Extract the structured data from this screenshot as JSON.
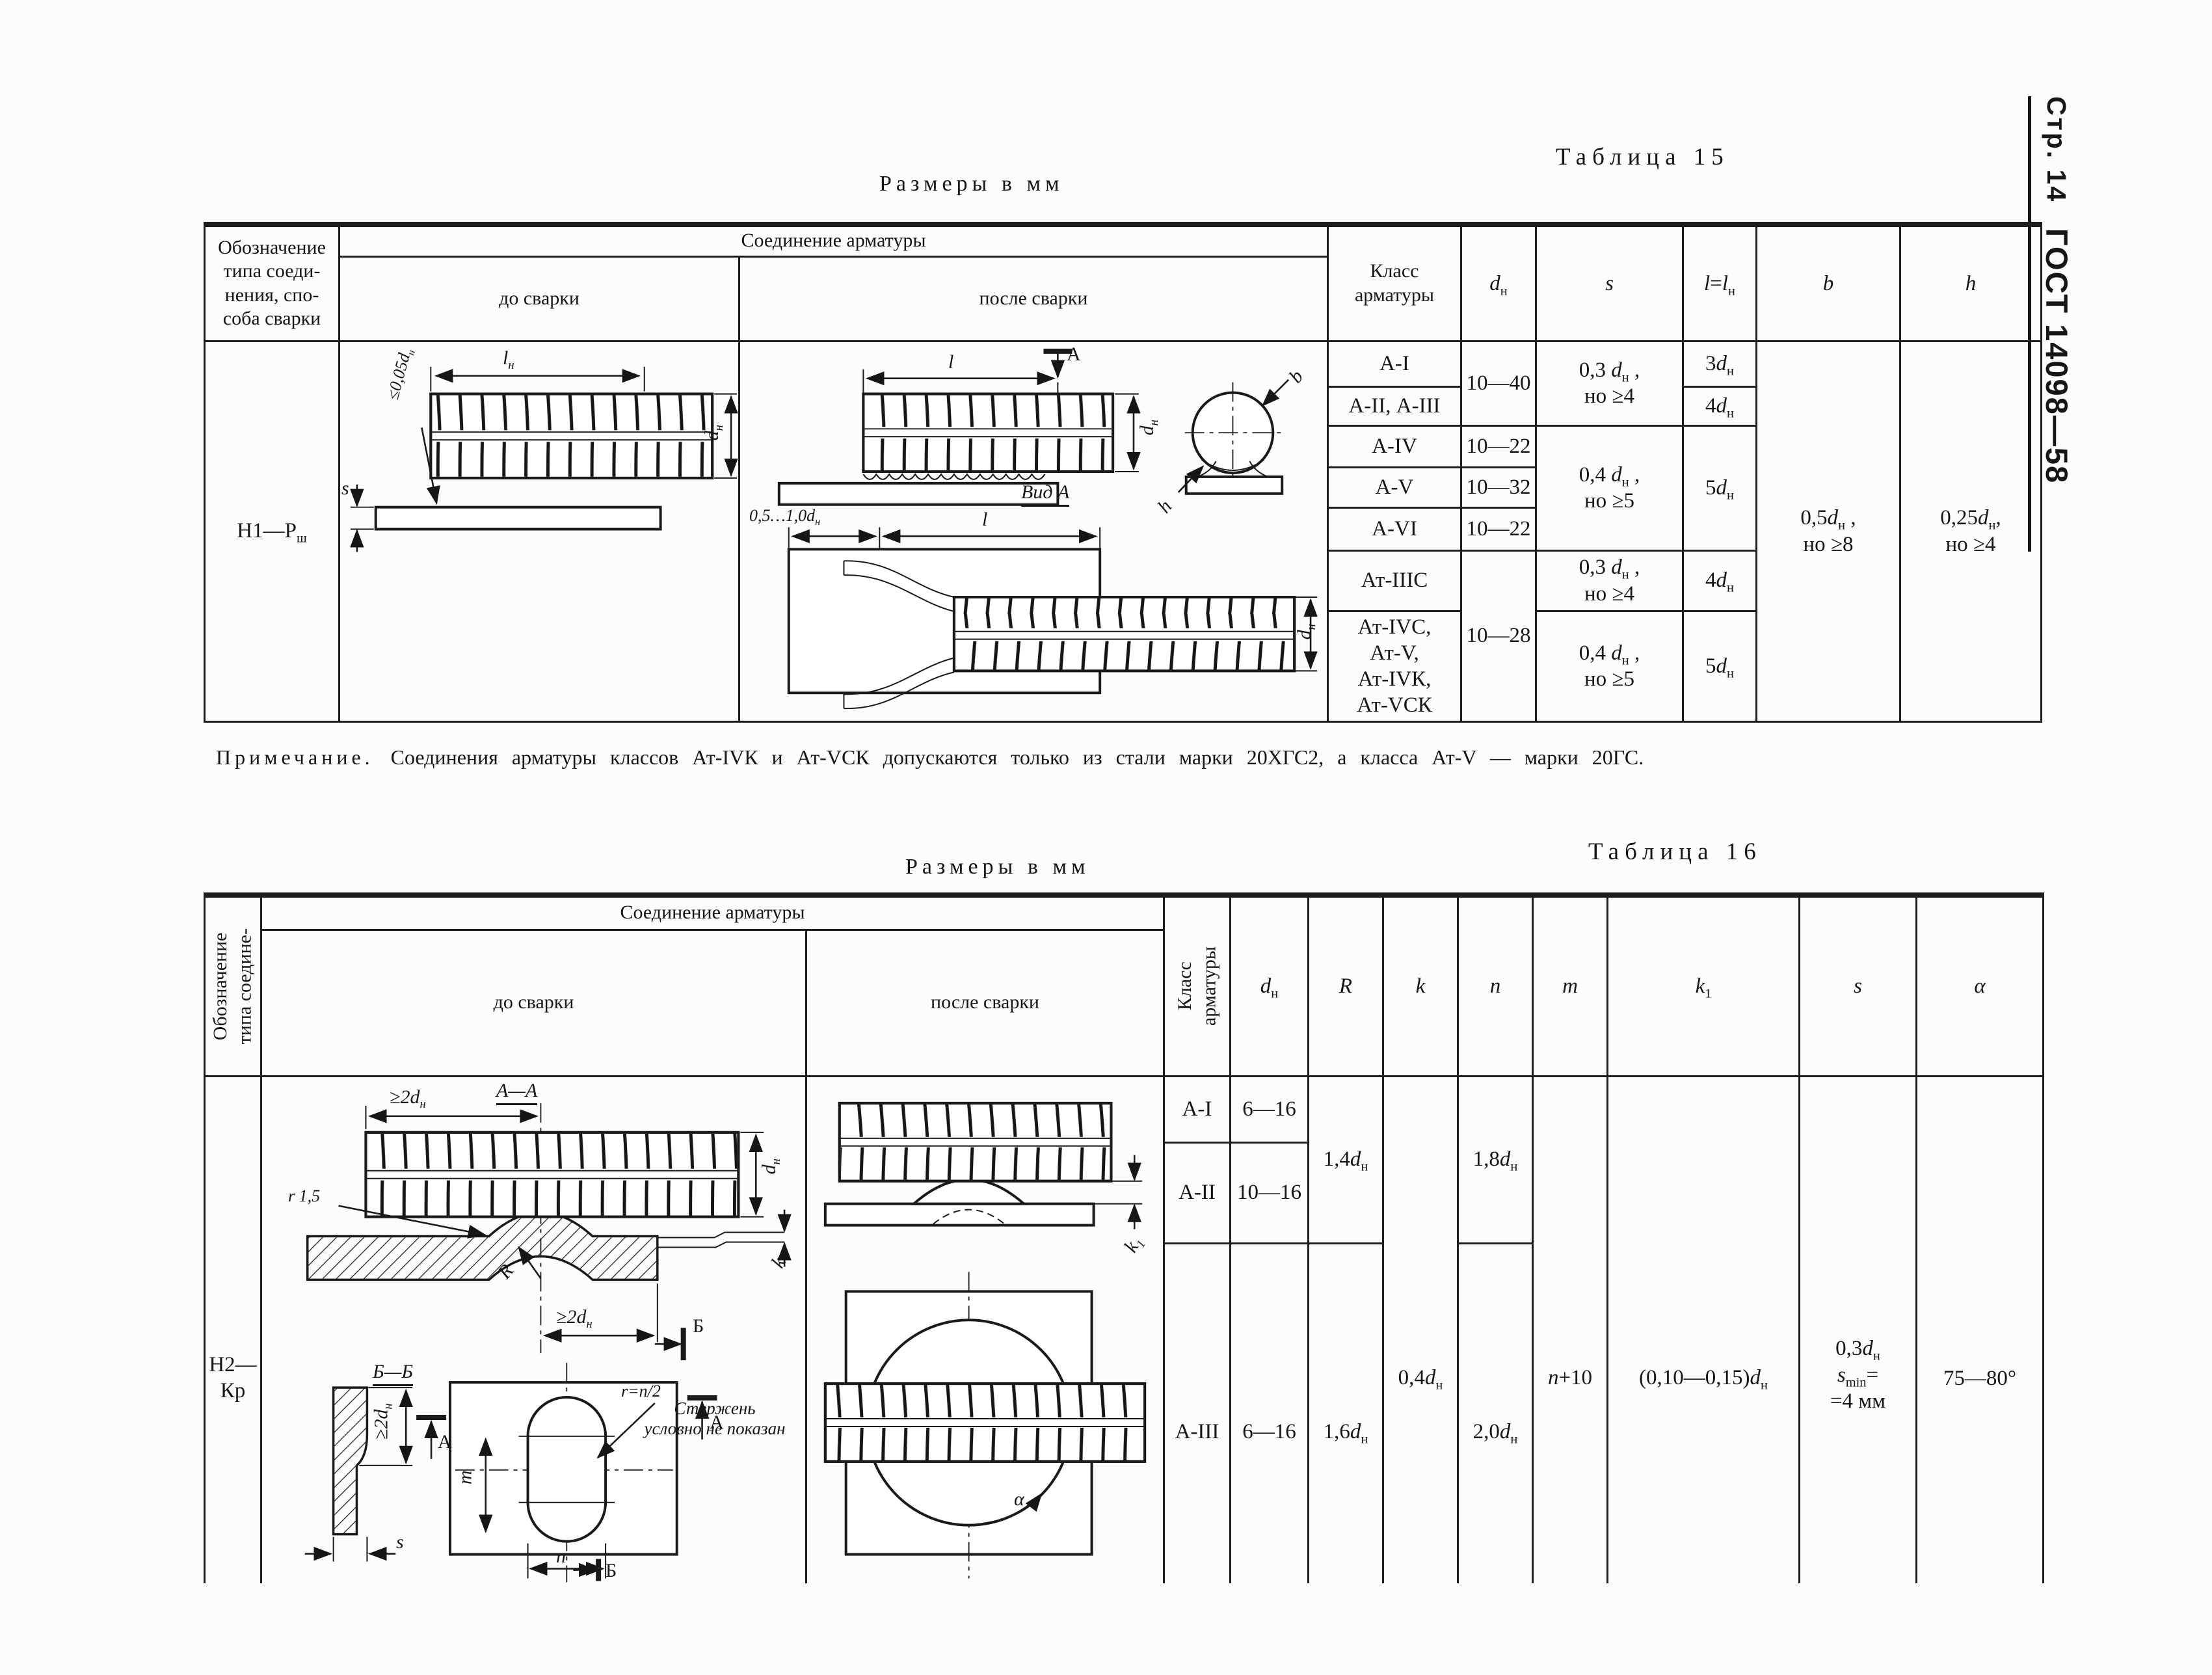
{
  "margin": {
    "page": "Стр. 14",
    "gost": "ГОСТ 14098—58"
  },
  "t15": {
    "caption": "Таблица 15",
    "units": "Размеры в мм",
    "head": {
      "designation": "Обозначение\nтипа соеди-\nнения, спо-\nсоба сварки",
      "joint": "Соединение арматуры",
      "before": "до сварки",
      "after": "после сварки",
      "klass": "Класс\nарматуры",
      "dn": "{d}[н]",
      "s": "{s}",
      "l": "{l}={l}[н]",
      "b": "{b}",
      "h": "{h}"
    },
    "designation": "Н1—Р[ш]",
    "cells": {
      "k1": "А-I",
      "k2": "А-II, А-III",
      "k3": "А-IV",
      "k4": "А-V",
      "k5": "А-VI",
      "k6": "Ат-IIIС",
      "k7": "Ат-IVС,\nАт-V,\nАт-IVК,\nАт-VСК",
      "dn12": "10—40",
      "dn3": "10—22",
      "dn4": "10—32",
      "dn5": "10—22",
      "dn67": "10—28",
      "s12": "0,3 {d}[н] ,\nно ≥4",
      "s345": "0,4 {d}[н] ,\nно ≥5",
      "s6": "0,3 {d}[н] ,\nно ≥4",
      "s7": "0,4 {d}[н] ,\nно ≥5",
      "l1": "3{d}[н]",
      "l2": "4{d}[н]",
      "l345": "5{d}[н]",
      "l6": "4{d}[н]",
      "l7": "5{d}[н]",
      "b": "0,5{d}[н] ,\nно ≥8",
      "h": "0,25{d}[н],\nно ≥4"
    },
    "fig_before": {
      "ln": "{l}[н]",
      "tol": "≤0,05{d}[н]",
      "s": "{s}",
      "dn": "{d}[н]"
    },
    "fig_after": {
      "l": "{l}",
      "sect": "А",
      "dn": "{d}[н]",
      "vid": "Вид А",
      "b": "{b}",
      "h": "{h}",
      "gap": "0,5…1,0{d}[н]",
      "l2": "{l}",
      "dn2": "{d}[н]"
    },
    "note_label": "Примечание.",
    "note_text": "Соединения арматуры классов Ат-IVК и Ат-VСК допускаются только из стали марки 20ХГС2, а класса Ат-V — марки 20ГС."
  },
  "t16": {
    "caption": "Таблица 16",
    "units": "Размеры в мм",
    "head": {
      "designation": "Обозначение\nтипа соедине-\nния, способа\nсварки",
      "joint": "Соединение арматуры",
      "before": "до сварки",
      "after": "после сварки",
      "klass": "Класс\nарматуры",
      "dn": "{d}[н]",
      "R": "{R}",
      "k": "{k}",
      "n": "{n}",
      "m": "{m}",
      "k1": "{k}[1]",
      "s": "{s}",
      "alpha": "α"
    },
    "designation": "Н2—Кр",
    "cells": {
      "k1": "А-I",
      "k2": "А-II",
      "k3": "А-III",
      "dn1": "6—16",
      "dn2": "10—16",
      "dn3": "6—16",
      "R12": "1,4{d}[н]",
      "R3": "1,6{d}[н]",
      "k": "0,4{d}[н]",
      "n12": "1,8{d}[н]",
      "n3": "2,0{d}[н]",
      "m": "{n}+10",
      "k1col": "(0,10—0,15){d}[н]",
      "s": "0,3{d}[н]\n{s}[min]=\n=4 мм",
      "alpha": "75—80°"
    },
    "fig_before": {
      "aa": "А—А",
      "top2dn": "≥2{d}[н]",
      "r15": "r 1,5",
      "dn": "{d}[н]",
      "k": "{k}",
      "R": "R",
      "bot2dn": "≥2{d}[н]",
      "secB1": "Б",
      "bb": "Б—Б",
      "v2dn": "≥2{d}[н]",
      "s": "{s}",
      "secA1": "А",
      "secA2": "А",
      "rn2": "r=n/2",
      "m": "{m}",
      "n": "{n}",
      "secB2": "Б",
      "note": "Стержень\nусловно не показан"
    },
    "fig_after": {
      "k1": "{k}[1]",
      "alpha": "α"
    }
  }
}
